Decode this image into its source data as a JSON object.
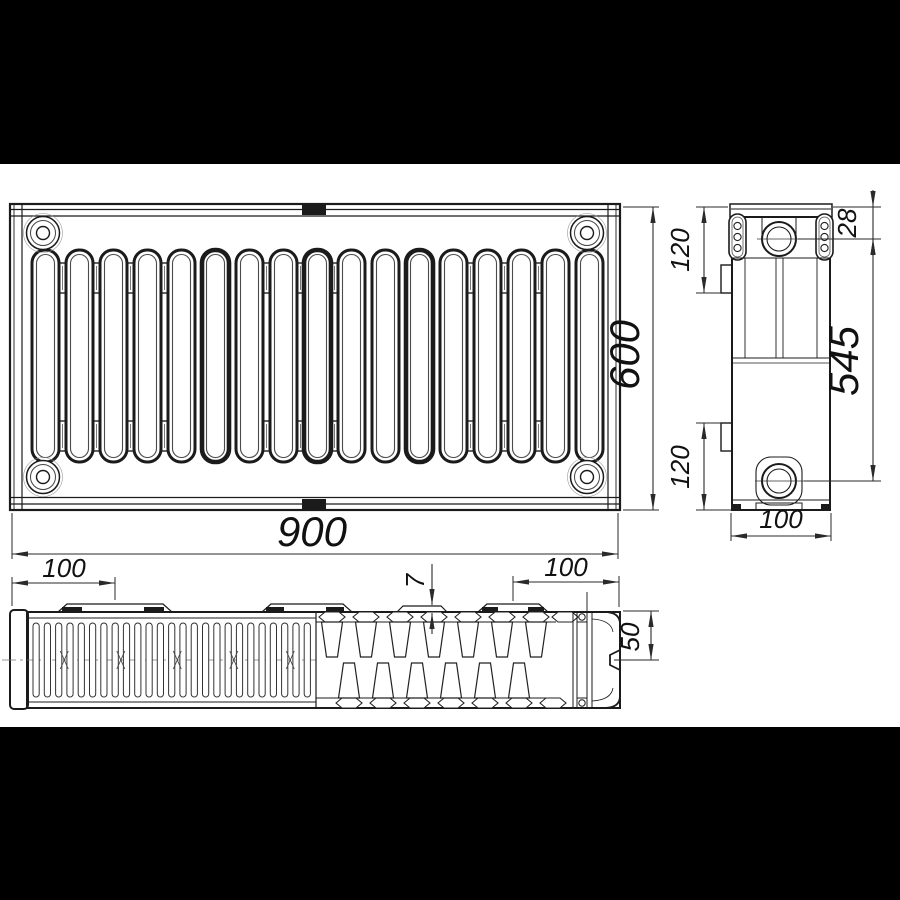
{
  "drawing": {
    "type": "panel-radiator-technical-drawing",
    "dims": {
      "front_width": "900",
      "front_height": "600",
      "side_top_port_offset": "28",
      "side_upper_bracket": "120",
      "side_lower_bracket": "120",
      "side_port_spacing": "545",
      "side_depth": "100",
      "top_left_tab_offset": "100",
      "top_right_tab_offset": "100",
      "top_tab_height": "7",
      "top_half_depth": "50"
    },
    "colors": {
      "background": "#ffffff",
      "letterbox": "#000000",
      "object_line": "#1b1b1b",
      "dimension_line": "#2a2a2a",
      "text": "#111111"
    }
  }
}
